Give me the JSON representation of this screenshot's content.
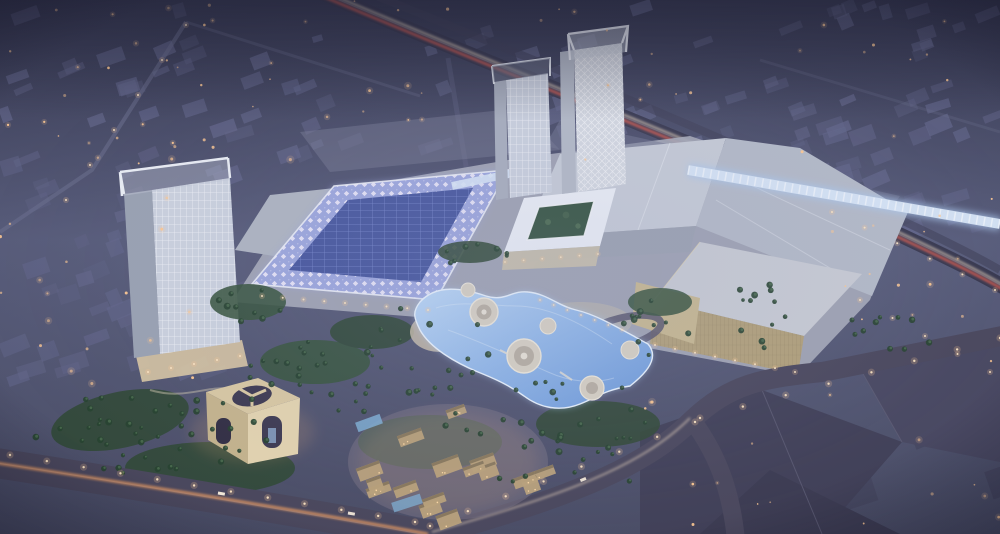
{
  "scene": {
    "description": "Dusk aerial rendering of a large shopping-mall development: three white lattice-facade towers, a mall hall with a glowing lavender diamond-pattern roof and dark solar panels, a white colonnaded courtyard building, pale flat mall roofs, a sand-gold anchor store, a glowing blue lagoon plaza with circular islands, a warm-lit low-rise souk village, a cubic gate monument with arched openings, palm-lined boulevards with light trails, and a surrounding purple-grey city grid dotted with warm lights.",
    "time_of_day": "dusk",
    "view": "aerial-oblique"
  },
  "palette": {
    "bg_top": "#34364e",
    "bg_mid": "#565a78",
    "bg_low": "#474a62",
    "city_block": "#616488",
    "city_block_dark": "#3f3f57",
    "road": "#3b3a50",
    "trail_red": "#ff6148",
    "trail_warm": "#ffa55e",
    "trail_white": "#ffe8c8",
    "streetlight_warm": "#ffc890",
    "roof_gray": "#c7ccd6",
    "roof_gray_dark": "#b4bac7",
    "roof_edge": "#eef1f7",
    "glow_roof_base": "#9ca6dd",
    "glow_roof_panel": "#44549c",
    "canopy_glass": "#d9e7f7",
    "tower_face": "#ccd2de",
    "tower_side": "#99a1b1",
    "tower_crown": "#ebeef4",
    "mall_podium": "#a7abb8",
    "gold_wall": "#b2a077",
    "gold_wall_light": "#c8b88e",
    "gold_roof": "#c9ccd3",
    "lagoon_deep": "#6a97d8",
    "lagoon_light": "#bcd8f6",
    "lagoon_edge": "#e9f3fd",
    "sand": "#cec2ab",
    "island_fill": "#d8d1c2",
    "green_dark": "#2d4631",
    "green_light": "#4d7050",
    "palm_dark": "#24402b",
    "village_wall": "#bba178",
    "village_roof": "#837257",
    "window_warm": "#ffd9a2",
    "arch_face": "#e4d4ae",
    "arch_side": "#c5b38b",
    "arch_top": "#d9c8a1",
    "arch_dark": "#3b374e"
  },
  "procedural": {
    "seed": 7,
    "city_blocks": [
      {
        "x": 0,
        "y": 0,
        "w": 1000,
        "h": 150,
        "count": 95,
        "scale": 1,
        "dark": false
      },
      {
        "x": 0,
        "y": 150,
        "w": 230,
        "h": 230,
        "count": 42,
        "scale": 1.1,
        "dark": false
      },
      {
        "x": 760,
        "y": 90,
        "w": 240,
        "h": 140,
        "count": 22,
        "scale": 1.1,
        "dark": false
      },
      {
        "x": 640,
        "y": 395,
        "w": 360,
        "h": 135,
        "count": 10,
        "scale": 2.0,
        "dark": true
      }
    ],
    "ambient_lights": [
      {
        "x": 0,
        "y": 0,
        "w": 1000,
        "h": 160,
        "count": 62
      },
      {
        "x": 0,
        "y": 160,
        "w": 200,
        "h": 250,
        "count": 18
      },
      {
        "x": 820,
        "y": 150,
        "w": 180,
        "h": 230,
        "count": 14
      },
      {
        "x": 620,
        "y": 390,
        "w": 380,
        "h": 140,
        "count": 16
      }
    ],
    "palm_clusters": [
      {
        "cx": 150,
        "cy": 432,
        "rx": 120,
        "ry": 48,
        "count": 42
      },
      {
        "cx": 315,
        "cy": 382,
        "rx": 85,
        "ry": 42,
        "count": 26
      },
      {
        "cx": 430,
        "cy": 350,
        "rx": 60,
        "ry": 48,
        "count": 20
      },
      {
        "cx": 560,
        "cy": 440,
        "rx": 125,
        "ry": 62,
        "count": 36
      },
      {
        "cx": 660,
        "cy": 330,
        "rx": 42,
        "ry": 30,
        "count": 12
      },
      {
        "cx": 762,
        "cy": 305,
        "rx": 30,
        "ry": 52,
        "count": 12
      },
      {
        "cx": 900,
        "cy": 332,
        "rx": 62,
        "ry": 20,
        "count": 10
      },
      {
        "cx": 244,
        "cy": 300,
        "rx": 40,
        "ry": 24,
        "count": 9
      },
      {
        "cx": 470,
        "cy": 255,
        "rx": 40,
        "ry": 14,
        "count": 8
      }
    ],
    "village_blocks": [
      {
        "cx": 448,
        "cy": 462,
        "rx": 95,
        "ry": 55,
        "count": 16
      }
    ],
    "streetlights": [
      {
        "x1": 10,
        "y1": 455,
        "x2": 415,
        "y2": 522,
        "count": 12,
        "r": 1.2
      },
      {
        "x1": 430,
        "y1": 526,
        "x2": 695,
        "y2": 422,
        "count": 8,
        "r": 1.2
      },
      {
        "x1": 700,
        "y1": 418,
        "x2": 1000,
        "y2": 338,
        "count": 8,
        "r": 1.2
      },
      {
        "x1": 186,
        "y1": 25,
        "x2": 66,
        "y2": 200,
        "count": 6,
        "r": 1.0
      },
      {
        "x1": 832,
        "y1": 212,
        "x2": 995,
        "y2": 290,
        "count": 6,
        "r": 1.0
      },
      {
        "x1": 262,
        "y1": 296,
        "x2": 428,
        "y2": 310,
        "count": 9,
        "r": 1.0
      },
      {
        "x1": 505,
        "y1": 262,
        "x2": 598,
        "y2": 254,
        "count": 6,
        "r": 0.9
      },
      {
        "x1": 540,
        "y1": 300,
        "x2": 622,
        "y2": 330,
        "count": 7,
        "r": 0.9
      },
      {
        "x1": 655,
        "y1": 345,
        "x2": 795,
        "y2": 372,
        "count": 8,
        "r": 1.0
      },
      {
        "x1": 860,
        "y1": 300,
        "x2": 990,
        "y2": 372,
        "count": 5,
        "r": 1.0
      },
      {
        "x1": 148,
        "y1": 372,
        "x2": 240,
        "y2": 356,
        "count": 5,
        "r": 1.0
      }
    ]
  }
}
